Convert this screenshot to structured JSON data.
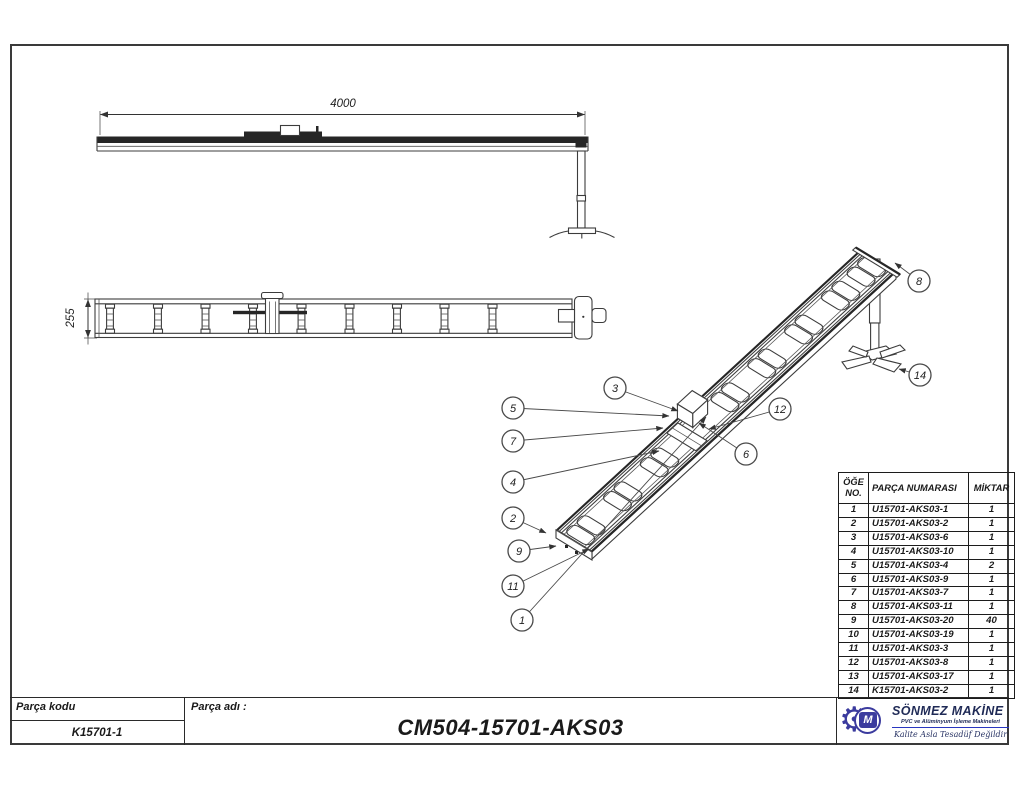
{
  "sheet": {
    "background": "#ffffff",
    "border_color": "#3a3a3a"
  },
  "views": {
    "top": {
      "dimension_label": "4000"
    },
    "side": {
      "dimension_label": "255"
    }
  },
  "isometric": {
    "balloons": [
      {
        "label": "1",
        "x": 522,
        "y": 620,
        "tx": 706,
        "ty": 417
      },
      {
        "label": "2",
        "x": 513,
        "y": 518,
        "tx": 546,
        "ty": 533
      },
      {
        "label": "3",
        "x": 615,
        "y": 388,
        "tx": 678,
        "ty": 411
      },
      {
        "label": "4",
        "x": 513,
        "y": 482,
        "tx": 659,
        "ty": 451
      },
      {
        "label": "5",
        "x": 513,
        "y": 408,
        "tx": 669,
        "ty": 416
      },
      {
        "label": "6",
        "x": 746,
        "y": 454,
        "tx": 699,
        "ty": 423
      },
      {
        "label": "7",
        "x": 513,
        "y": 441,
        "tx": 663,
        "ty": 428
      },
      {
        "label": "8",
        "x": 919,
        "y": 281,
        "tx": 895,
        "ty": 263
      },
      {
        "label": "9",
        "x": 519,
        "y": 551,
        "tx": 556,
        "ty": 546
      },
      {
        "label": "11",
        "x": 513,
        "y": 586,
        "tx": 589,
        "ty": 549
      },
      {
        "label": "12",
        "x": 780,
        "y": 409,
        "tx": 709,
        "ty": 429
      },
      {
        "label": "14",
        "x": 920,
        "y": 375,
        "tx": 899,
        "ty": 369
      }
    ]
  },
  "bom": {
    "headers": {
      "no": "ÖĞE NO.",
      "part": "PARÇA NUMARASI",
      "qty": "MİKTAR"
    },
    "rows": [
      {
        "no": "1",
        "part": "U15701-AKS03-1",
        "qty": "1"
      },
      {
        "no": "2",
        "part": "U15701-AKS03-2",
        "qty": "1"
      },
      {
        "no": "3",
        "part": "U15701-AKS03-6",
        "qty": "1"
      },
      {
        "no": "4",
        "part": "U15701-AKS03-10",
        "qty": "1"
      },
      {
        "no": "5",
        "part": "U15701-AKS03-4",
        "qty": "2"
      },
      {
        "no": "6",
        "part": "U15701-AKS03-9",
        "qty": "1"
      },
      {
        "no": "7",
        "part": "U15701-AKS03-7",
        "qty": "1"
      },
      {
        "no": "8",
        "part": "U15701-AKS03-11",
        "qty": "1"
      },
      {
        "no": "9",
        "part": "U15701-AKS03-20",
        "qty": "40"
      },
      {
        "no": "10",
        "part": "U15701-AKS03-19",
        "qty": "1"
      },
      {
        "no": "11",
        "part": "U15701-AKS03-3",
        "qty": "1"
      },
      {
        "no": "12",
        "part": "U15701-AKS03-8",
        "qty": "1"
      },
      {
        "no": "13",
        "part": "U15701-AKS03-17",
        "qty": "1"
      },
      {
        "no": "14",
        "part": "K15701-AKS03-2",
        "qty": "1"
      }
    ]
  },
  "title_block": {
    "part_code_label": "Parça kodu",
    "part_code_value": "K15701-1",
    "part_name_label": "Parça adı :",
    "part_name_value": "CM504-15701-AKS03"
  },
  "logo": {
    "company": "SÖNMEZ MAKİNE",
    "tagline": "PVC ve Alüminyum İşleme Makineleri",
    "slogan": "Kalite Asla Tesadüf Değildir",
    "monogram": "M",
    "gear_icon": "⚙",
    "navy": "#1f2a56",
    "blue": "#2936c0",
    "indigo": "#3b3b9e"
  }
}
